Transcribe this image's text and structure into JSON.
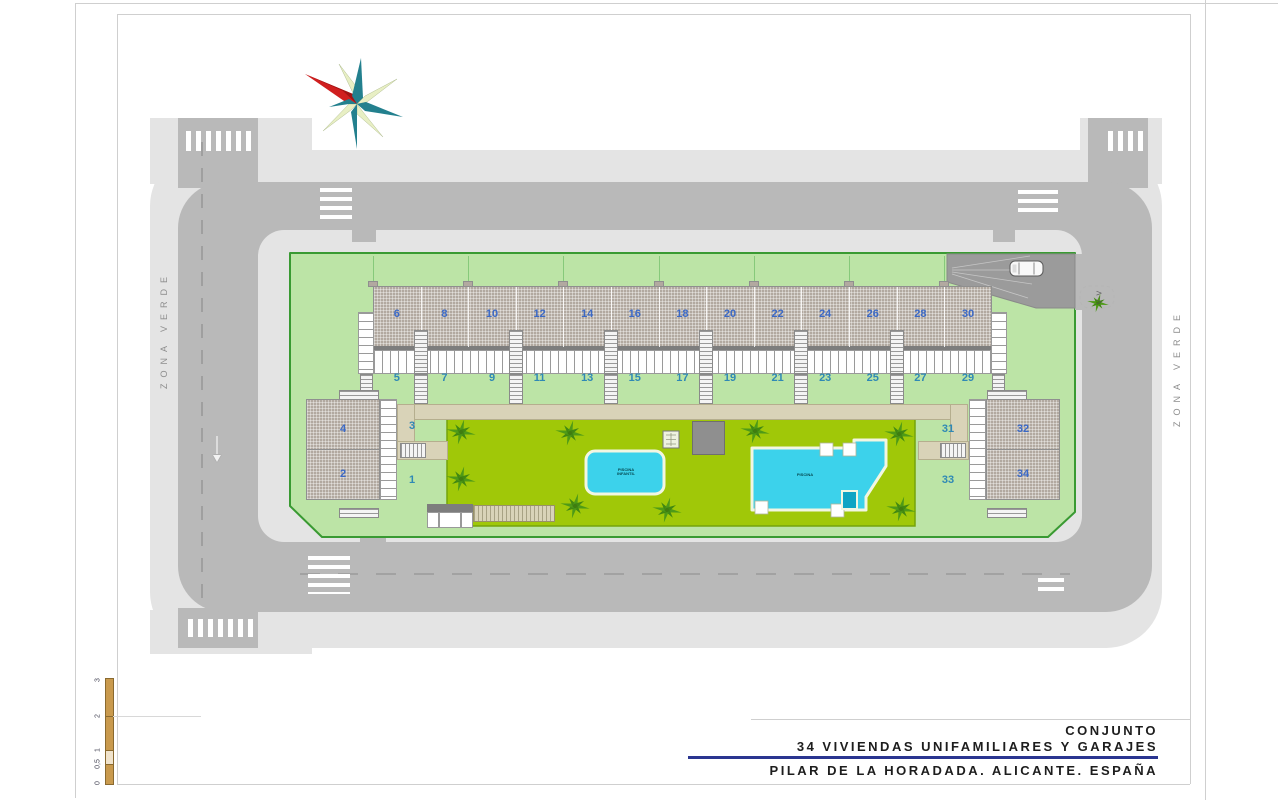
{
  "title_block": {
    "line1": "CONJUNTO",
    "line2": "34 VIVIENDAS UNIFAMILIARES Y GARAJES",
    "line3": "PILAR DE LA HORADADA. ALICANTE. ESPAÑA",
    "accent_color": "#2a3590"
  },
  "labels": {
    "zona_verde_left": "ZONA VERDE",
    "zona_verde_right": "ZONA VERDE",
    "section_marker": "V-V",
    "pool_main_line1": "PISCINA",
    "pool_kids_line1": "PISCINA",
    "pool_kids_line2": "INFANTIL"
  },
  "scale_bar": {
    "ticks": [
      "3",
      "2",
      "1",
      "0,5",
      "0"
    ]
  },
  "site": {
    "row_evens": [
      "6",
      "8",
      "10",
      "12",
      "14",
      "16",
      "18",
      "20",
      "22",
      "24",
      "26",
      "28",
      "30"
    ],
    "row_odds": [
      "5",
      "7",
      "9",
      "11",
      "13",
      "15",
      "17",
      "19",
      "21",
      "23",
      "25",
      "27",
      "29"
    ],
    "left_block": {
      "top": "4",
      "bottom": "2",
      "garden_top": "3",
      "garden_bottom": "1"
    },
    "right_block": {
      "top": "32",
      "bottom": "34",
      "garden_top": "31",
      "garden_bottom": "33"
    }
  },
  "palms": [
    [
      461,
      432
    ],
    [
      570,
      433
    ],
    [
      755,
      431
    ],
    [
      899,
      434
    ],
    [
      461,
      479
    ],
    [
      575,
      506
    ],
    [
      667,
      510
    ],
    [
      901,
      509
    ],
    [
      1098,
      303
    ]
  ],
  "colors": {
    "road": "#b9b9b9",
    "sidewalk": "#e4e4e4",
    "parcel": "#bce4a6",
    "garden": "#a0c808",
    "pool": "#3cd2eb",
    "roof": "#b2a9a0",
    "walk": "#d9d3b8",
    "number_even": "#3b69c6",
    "number_odd": "#2f89b5",
    "compass_red": "#d01f1f",
    "compass_teal": "#23808e",
    "compass_pale": "#e8efc4"
  }
}
